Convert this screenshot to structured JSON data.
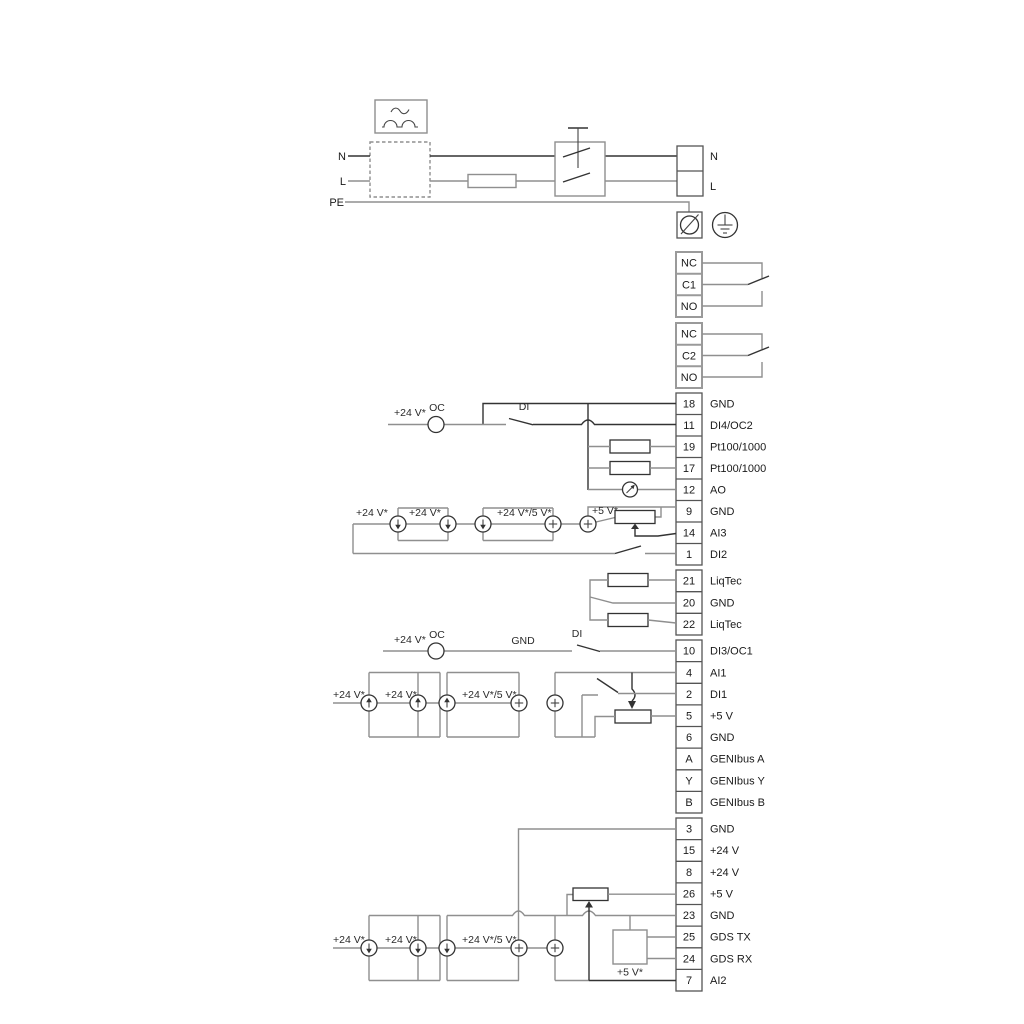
{
  "power": {
    "n": "N",
    "l": "L",
    "pe": "PE",
    "n_right": "N",
    "l_right": "L"
  },
  "relays": [
    {
      "cells": [
        {
          "label": "NC"
        },
        {
          "label": "C1"
        },
        {
          "label": "NO"
        }
      ]
    },
    {
      "cells": [
        {
          "label": "NC"
        },
        {
          "label": "C2"
        },
        {
          "label": "NO"
        }
      ]
    }
  ],
  "blocks": {
    "a": [
      {
        "num": "18",
        "label": "GND"
      },
      {
        "num": "11",
        "label": "DI4/OC2"
      },
      {
        "num": "19",
        "label": "Pt100/1000"
      },
      {
        "num": "17",
        "label": "Pt100/1000"
      },
      {
        "num": "12",
        "label": "AO"
      },
      {
        "num": "9",
        "label": "GND"
      },
      {
        "num": "14",
        "label": "AI3"
      },
      {
        "num": "1",
        "label": "DI2"
      }
    ],
    "b": [
      {
        "num": "21",
        "label": "LiqTec"
      },
      {
        "num": "20",
        "label": "GND"
      },
      {
        "num": "22",
        "label": "LiqTec"
      }
    ],
    "c": [
      {
        "num": "10",
        "label": "DI3/OC1"
      },
      {
        "num": "4",
        "label": "AI1"
      },
      {
        "num": "2",
        "label": "DI1"
      },
      {
        "num": "5",
        "label": "+5 V"
      },
      {
        "num": "6",
        "label": "GND"
      },
      {
        "num": "A",
        "label": "GENIbus A"
      },
      {
        "num": "Y",
        "label": "GENIbus Y"
      },
      {
        "num": "B",
        "label": "GENIbus B"
      }
    ],
    "d": [
      {
        "num": "3",
        "label": "GND"
      },
      {
        "num": "15",
        "label": "+24 V"
      },
      {
        "num": "8",
        "label": "+24 V"
      },
      {
        "num": "26",
        "label": "+5 V"
      },
      {
        "num": "23",
        "label": "GND"
      },
      {
        "num": "25",
        "label": "GDS TX"
      },
      {
        "num": "24",
        "label": "GDS RX"
      },
      {
        "num": "7",
        "label": "AI2"
      }
    ]
  },
  "ann": {
    "v24": "+24 V*",
    "v24v5": "+24 V*/5 V*",
    "v5": "+5 V*",
    "oc": "OC",
    "di": "DI",
    "gnd": "GND"
  },
  "colors": {
    "wire_gray": "#8f8f8f",
    "wire_dark": "#333333"
  }
}
